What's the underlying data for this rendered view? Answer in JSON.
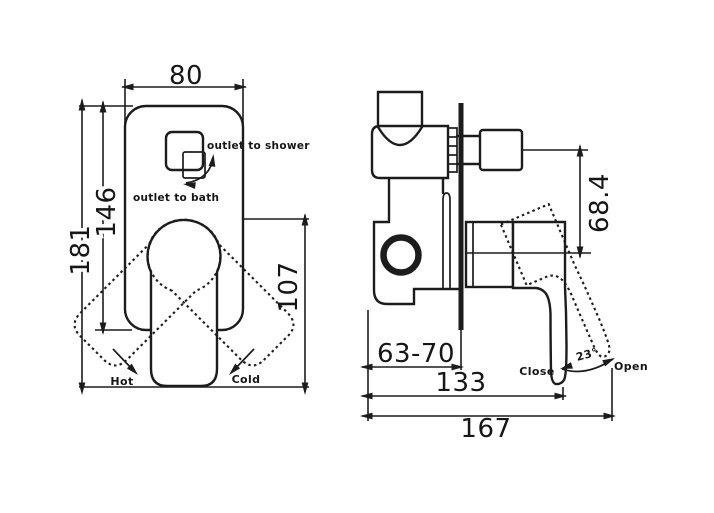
{
  "meta": {
    "type": "technical-drawing",
    "subject": "concealed shower/bath mixer valve, two orthographic views",
    "background_color": "#ffffff",
    "line_color": "#1c1c1c"
  },
  "front_view": {
    "dims": {
      "plate_width": "80",
      "plate_height": "146",
      "overall_height": "181",
      "handle_length": "107"
    },
    "labels": {
      "outlet_shower": "outlet to shower",
      "outlet_bath": "outlet to bath",
      "hot": "Hot",
      "cold": "Cold"
    }
  },
  "side_view": {
    "dims": {
      "knob_to_handle_axis": "68.4",
      "wall_depth_range": "63-70",
      "body_length": "133",
      "overall_length": "167",
      "swing_angle": "23°"
    },
    "labels": {
      "close": "Close",
      "open": "Open"
    }
  }
}
